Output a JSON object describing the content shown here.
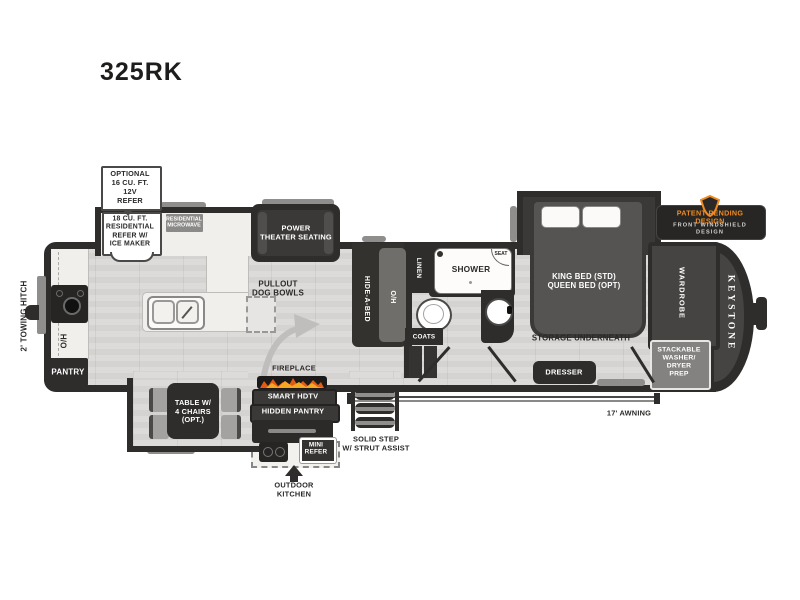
{
  "header": {
    "model": "325RK"
  },
  "badge": {
    "line1": "PATENT-PENDING DESIGN",
    "line2": "FRONT WINDSHIELD DESIGN",
    "shield_icon_color": "#f08a21"
  },
  "exterior": {
    "towing_hitch": "2' TOWING HITCH",
    "awning": "17' AWNING",
    "solid_step": "SOLID STEP\nW/ STRUT ASSIST",
    "outdoor_kitchen": "OUTDOOR\nKITCHEN",
    "mini_refer": "MINI\nREFER",
    "keystone": "KEYSTONE"
  },
  "kitchen": {
    "optional_refer_callout": "OPTIONAL\n16 CU. FT.\n12V\nREFER",
    "refer": "18 CU. FT.\nRESIDENTIAL\nREFER W/\nICE MAKER",
    "microwave": "RESIDENTIAL\nMICROWAVE",
    "pantry": "PANTRY",
    "overhead": "O/H",
    "island_note": "PULLOUT\nDOG BOWLS",
    "hidden_pantry": "HIDDEN PANTRY"
  },
  "living": {
    "theater_seating": "POWER\nTHEATER SEATING",
    "hide_a_bed": "HIDE-A-BED",
    "overhead": "O/H",
    "fireplace": "FIREPLACE",
    "smart_hdtv": "SMART HDTV",
    "table": "TABLE W/\n4 CHAIRS\n(OPT.)"
  },
  "bath": {
    "linen": "LINEN",
    "shower": "SHOWER",
    "seat": "SEAT",
    "coats": "COATS"
  },
  "bedroom": {
    "bed": "KING BED (STD)\nQUEEN BED (OPT)",
    "storage": "STORAGE UNDERNEATH",
    "dresser": "DRESSER",
    "wardrobe": "WARDROBE",
    "washer_prep": "STACKABLE\nWASHER/\nDRYER\nPREP"
  },
  "colors": {
    "wall": "#2e2d2c",
    "accent_orange": "#f08a21",
    "floor": "#d9d8d6",
    "counter": "#f1efec"
  }
}
